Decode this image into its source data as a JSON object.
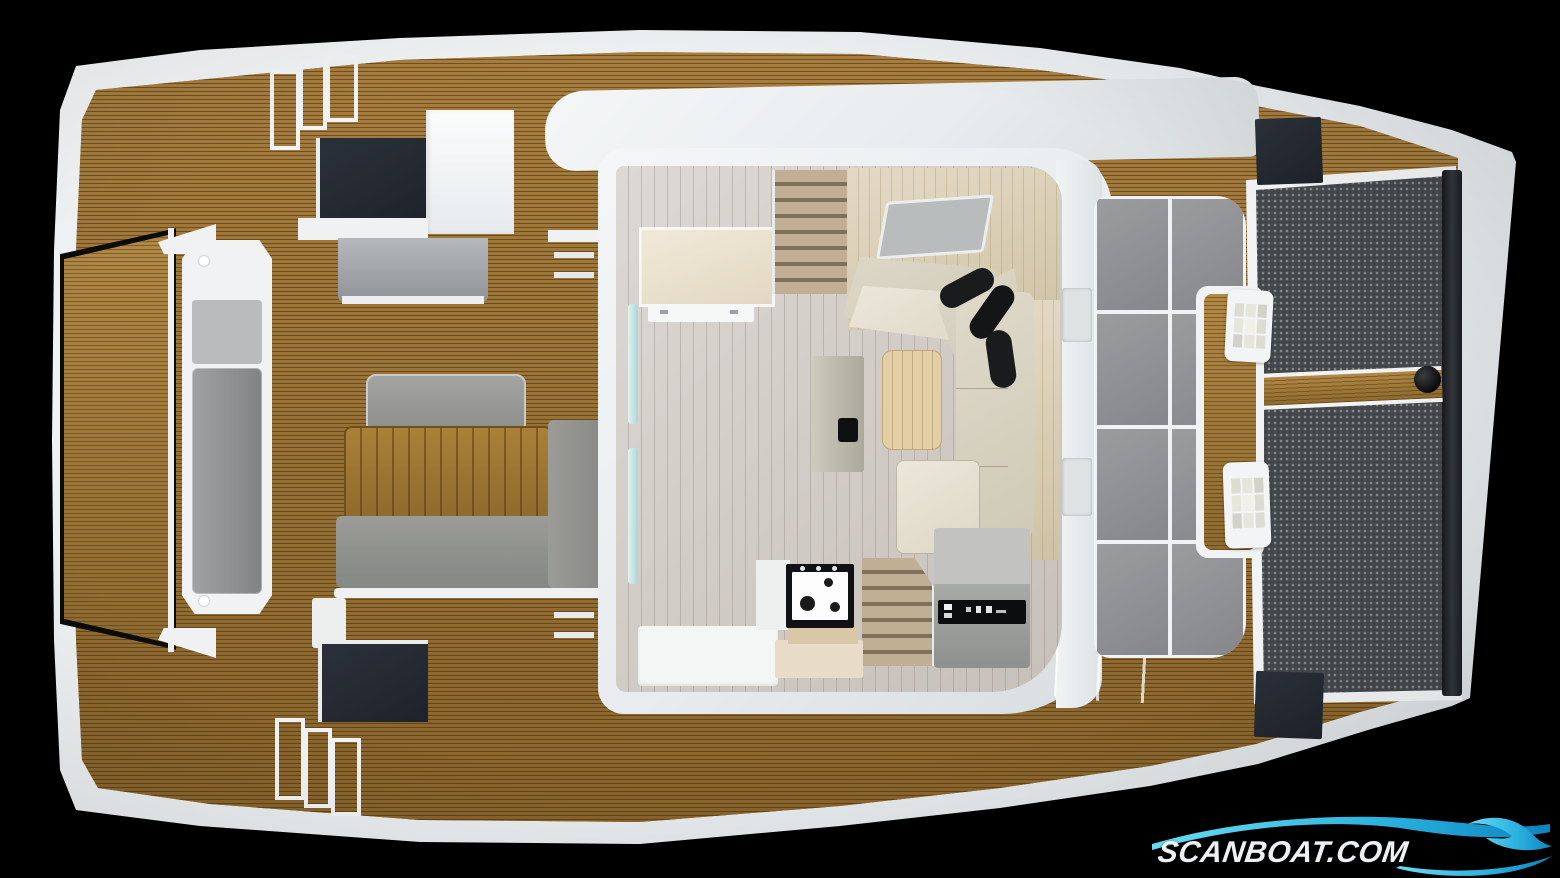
{
  "watermark": {
    "brand": "SCANBOAT.COM"
  },
  "icons": {
    "logo_wave": "wave-swoosh",
    "logo_crest": "wave-crest"
  },
  "palette": {
    "background": "#000000",
    "hull_white": "#edf0f2",
    "teak_deck": "#9a7333",
    "teak_stripe": "#5f441a",
    "saloon_floor": "#d8d2cc",
    "interior_wood": "#ddd2bb",
    "sofa_cream": "#e7e2d4",
    "cushion_black": "#1a1b1d",
    "cockpit_gray": "#94958f",
    "sunpad_gray": "#8f9092",
    "trampoline_mesh": "#43474b",
    "hatch_dark": "#262b33",
    "door_glass_cyan": "#bfe4e4",
    "logo_cyan_light": "#6adcf2",
    "logo_cyan_dark": "#0c84c0"
  }
}
